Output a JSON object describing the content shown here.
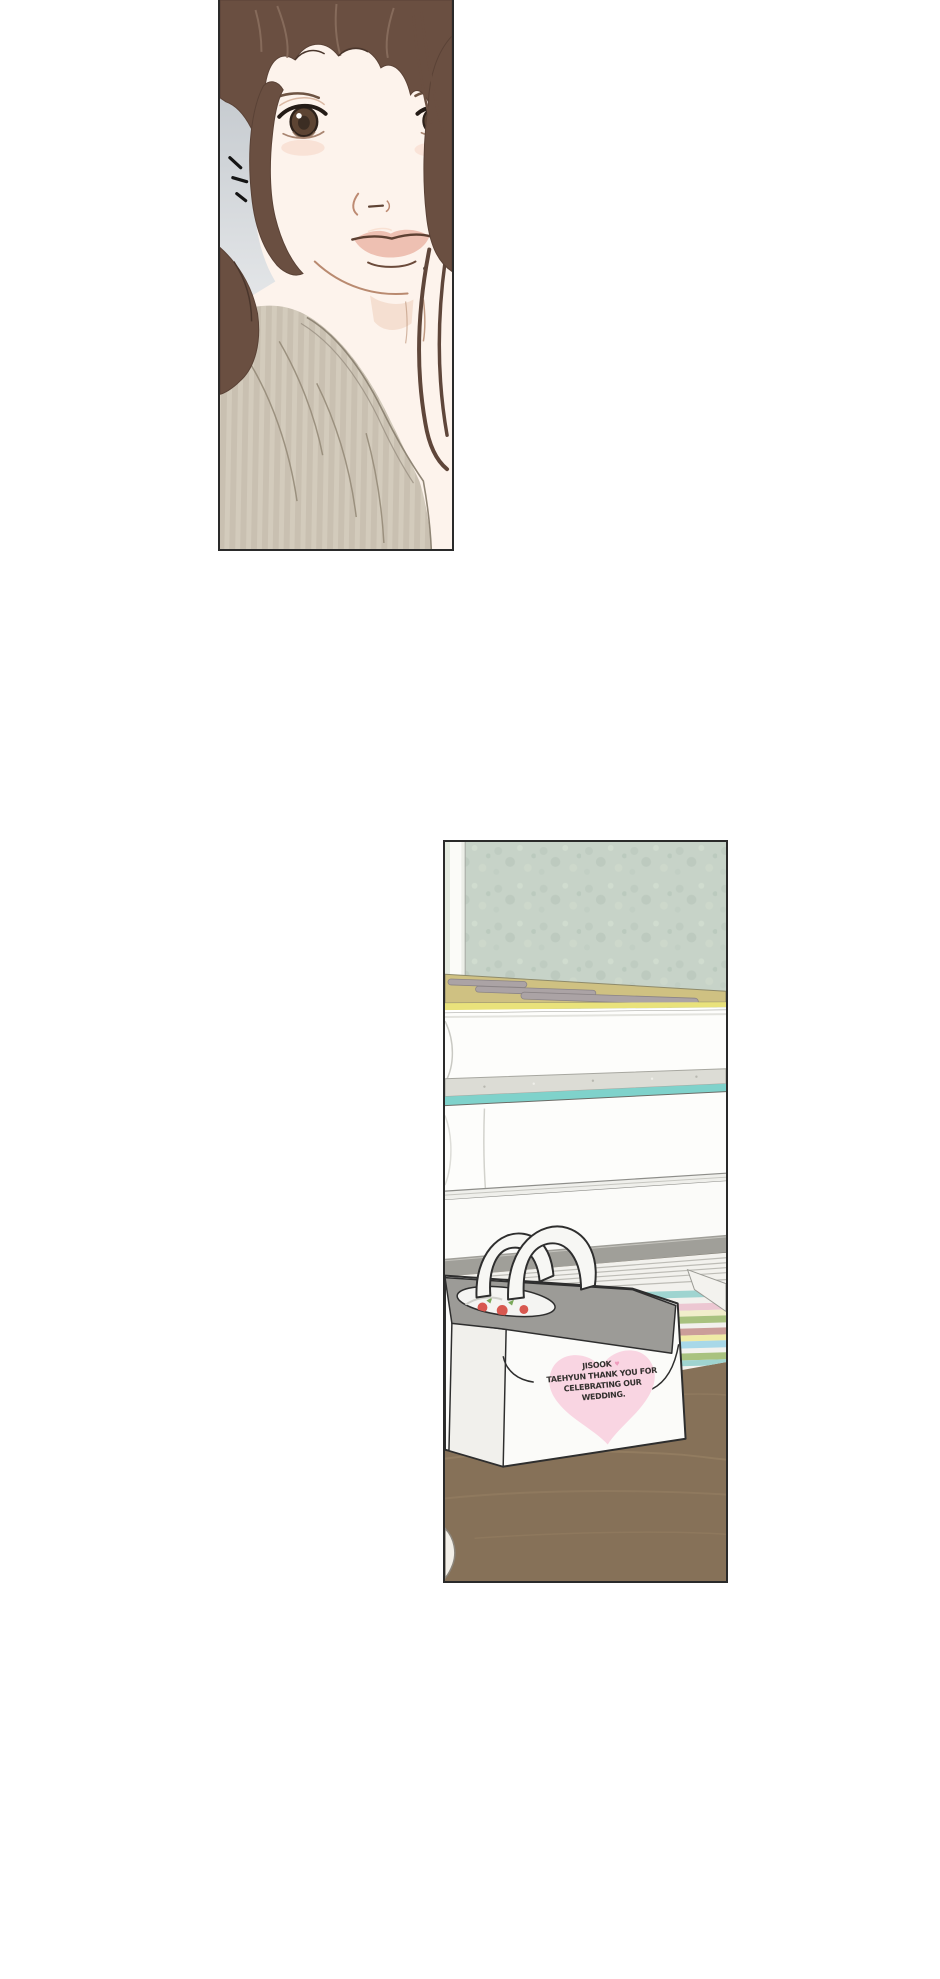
{
  "page": {
    "background": "#ffffff",
    "panel_border": "#2a2a2a"
  },
  "gift_box_label": {
    "line1_name": "JISOOK",
    "heart_symbol": "♥",
    "line2": "TAEHYUN THANK YOU FOR",
    "line3": "CELEBRATING OUR",
    "line4": "WEDDING."
  },
  "colors": {
    "heart_pink": "#f9d5e2",
    "label_text": "#33302e",
    "wallpaper_green": "#c7d3c8",
    "window_strip": "#fbfbf8",
    "desk_tan": "#cfc182",
    "desk_edge_yellow": "#e9e27b",
    "teal_accent": "#7fd2cb",
    "ledge_gray": "#a09f99",
    "table_brown": "#867158",
    "box_top_gray": "#9c9b97",
    "box_white": "#fbfbf9",
    "sweater_beige": "#c9c0b1",
    "hair_brown": "#6a4f41",
    "skin": "#fdf3ec",
    "backdrop_gray_top": "#c5cacf",
    "backdrop_gray_bottom": "#e6e8ea",
    "stripe_teal": "#9fd4d0",
    "stripe_pink": "#ecc7d2",
    "stripe_cream": "#f1eecb",
    "stripe_green": "#a9c27f",
    "stripe_rose": "#cb9d99",
    "stripe_yellow": "#efeaa6",
    "stripe_blue": "#a8d8e8"
  }
}
